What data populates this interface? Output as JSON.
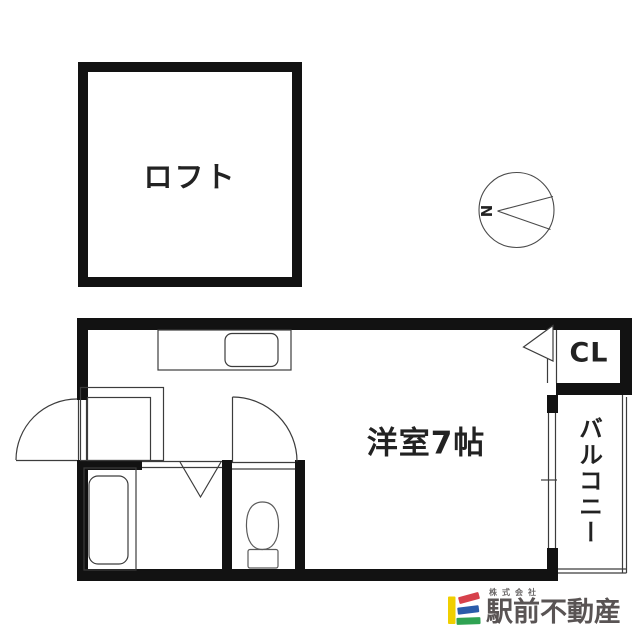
{
  "plan": {
    "loft_label": "ロフト",
    "main_room_label": "洋室7帖",
    "closet_label": "CL",
    "balcony_label": "バルコニー",
    "compass_north_label": "N"
  },
  "logo": {
    "company_prefix": "株式会社",
    "company_name": "駅前不動産",
    "mark_colors": {
      "yellow": "#f0cf00",
      "red": "#d6414b",
      "blue": "#2a5caa",
      "green": "#2fa353"
    },
    "text_color": "#595454"
  },
  "colors": {
    "wall": "#121212",
    "line": "#3c3c3c",
    "fixture_line": "#5a5a5a",
    "background": "#ffffff"
  }
}
